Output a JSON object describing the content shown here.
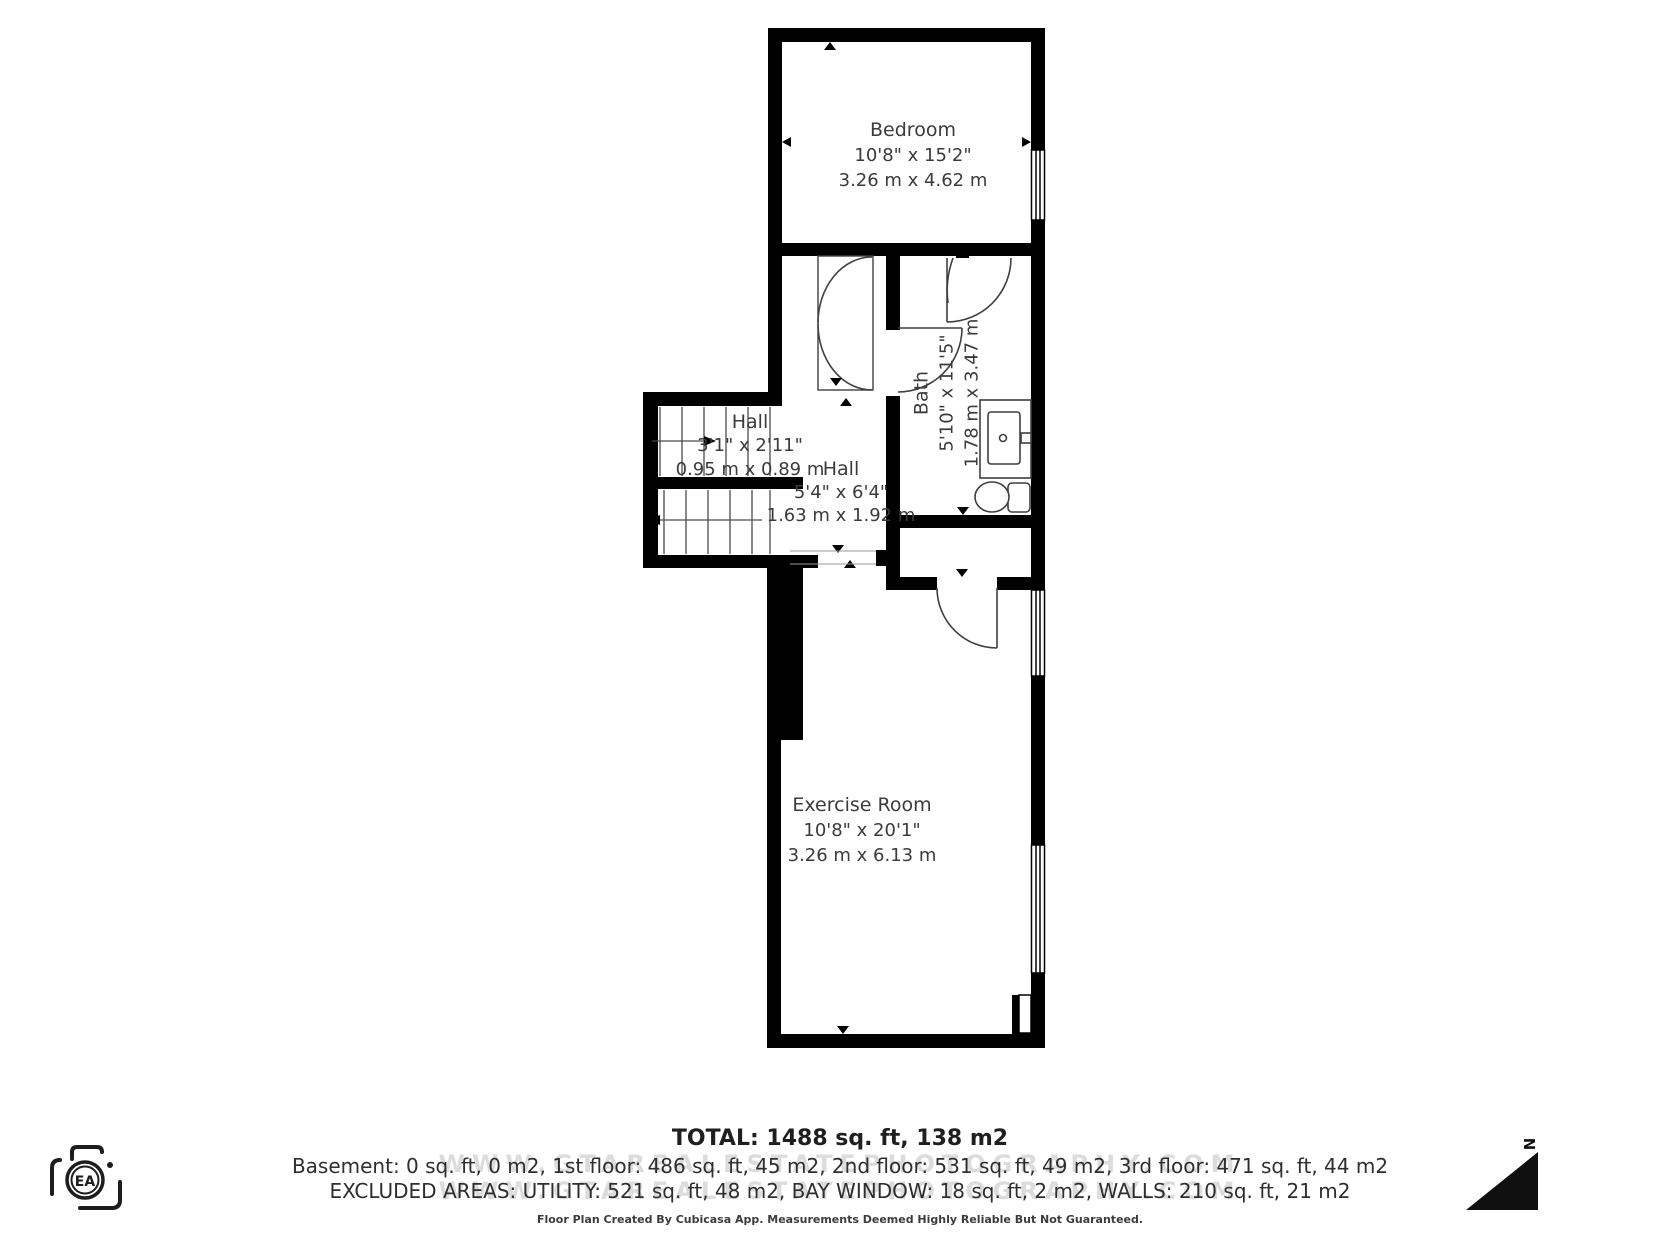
{
  "rooms": {
    "bedroom": {
      "label": "Bedroom",
      "dims_ft": "10'8\" x 15'2\"",
      "dims_m": "3.26 m x 4.62 m"
    },
    "bath": {
      "label": "Bath",
      "dims_ft": "5'10\" x 11'5\"",
      "dims_m": "1.78 m x 3.47 m"
    },
    "hall_small": {
      "label": "Hall",
      "dims_ft": "3'1\" x 2'11\"",
      "dims_m": "0.95 m x 0.89 m"
    },
    "hall": {
      "label": "Hall",
      "dims_ft": "5'4\" x 6'4\"",
      "dims_m": "1.63 m x 1.92 m"
    },
    "exercise": {
      "label": "Exercise Room",
      "dims_ft": "10'8\" x 20'1\"",
      "dims_m": "3.26 m x 6.13 m"
    }
  },
  "summary": {
    "total_line": "TOTAL: 1488 sq. ft, 138 m2",
    "floors_line": "Basement: 0 sq. ft, 0 m2, 1st floor: 486 sq. ft, 45 m2, 2nd floor: 531 sq. ft, 49 m2, 3rd floor: 471 sq. ft, 44 m2",
    "excluded_line": "EXCLUDED AREAS: UTILITY: 521 sq. ft, 48 m2, BAY WINDOW: 18 sq. ft, 2 m2, WALLS: 210 sq. ft, 21 m2",
    "disclaimer": "Floor Plan Created By Cubicasa App. Measurements Deemed Highly Reliable But Not Guaranteed."
  },
  "branding": {
    "camera_initials": "EA",
    "north_label": "N"
  },
  "watermark_text": "WWW.GTAREALESTATEPHOTOGRAPHY.COM",
  "colors": {
    "wall": "#000000",
    "label_text": "#3b3b3b",
    "door_stroke": "#3f3f3f",
    "stair_stroke": "#4a4a4a",
    "summary_text": "#1f1f1f"
  }
}
